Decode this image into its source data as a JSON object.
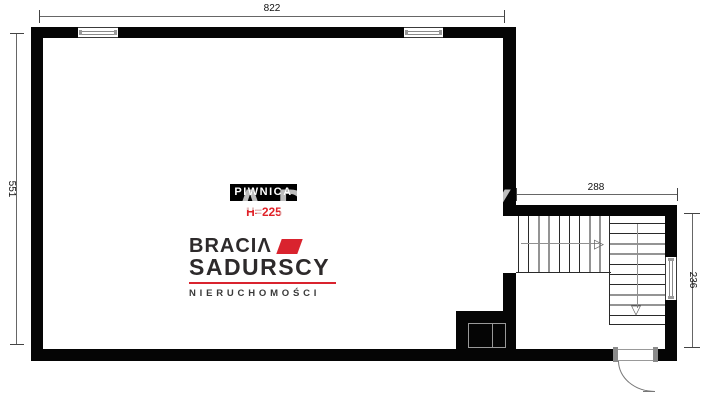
{
  "room": {
    "label": "PIWNICA",
    "height_note": "H=225"
  },
  "dimensions": {
    "top_width": "822",
    "left_height": "551",
    "stair_width": "288",
    "stair_height": "236"
  },
  "logo": {
    "line1": "BRACIΛ",
    "line2": "SADURSCY",
    "line3": "NIERUCHOMOŚCI"
  },
  "watermark_text": "SADURSCY",
  "icons": {
    "walk_arrow_right": "▷",
    "walk_arrow_down": "▽"
  },
  "colors": {
    "wall": "#050505",
    "brand_red": "#d9232e",
    "height_note_red": "#e02128",
    "dim_line_gray": "#666666",
    "walkline_gray": "#909090",
    "watermark_gray": "#bdbdbd"
  }
}
